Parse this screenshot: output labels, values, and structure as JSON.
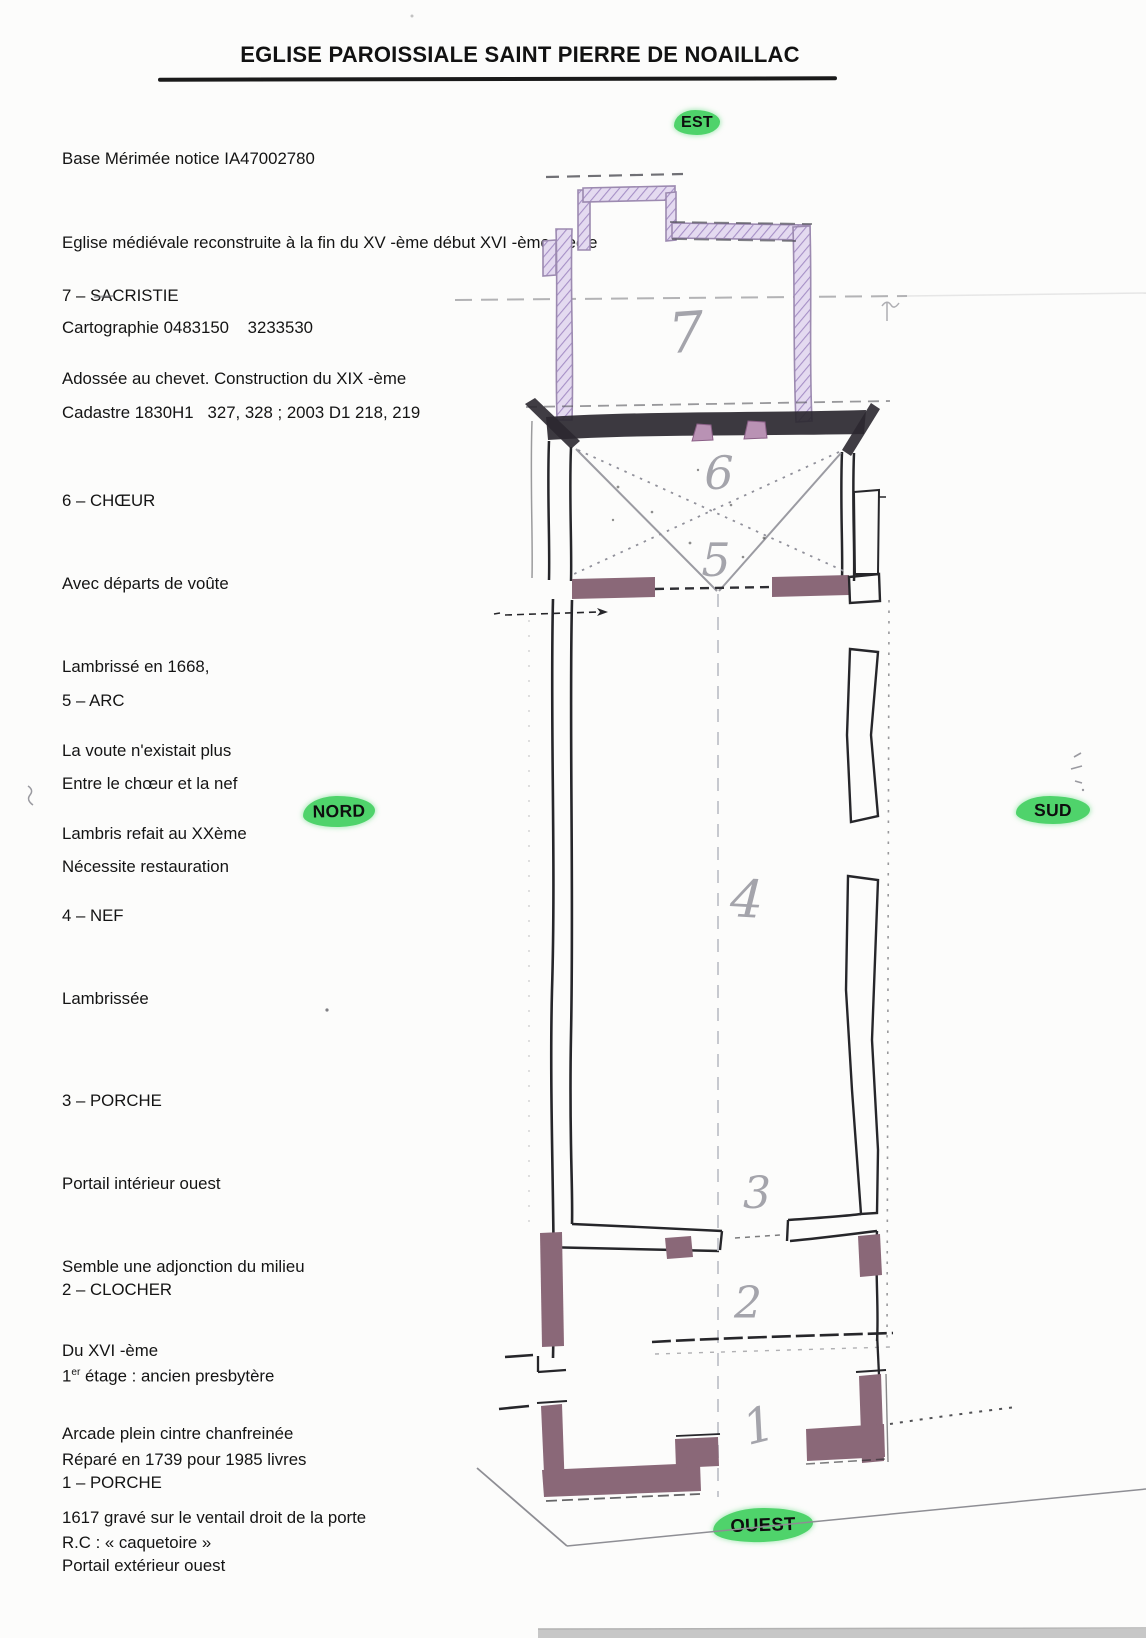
{
  "page_title": "EGLISE PAROISSIALE SAINT PIERRE DE NOAILLAC",
  "header": {
    "line1": "Base Mérimée notice IA47002780",
    "line2": "Eglise médiévale reconstruite à la fin du XV -ème début XVI -ème siècle",
    "line3": "Cartographie 0483150    3233530",
    "line4": "Cadastre 1830H1   327, 328 ; 2003 D1 218, 219"
  },
  "compass": {
    "est": "EST",
    "nord": "NORD",
    "sud": "SUD",
    "ouest": "OUEST"
  },
  "sections": {
    "s7": {
      "heading": "7 – SACRISTIE",
      "l1": "Adossée au chevet. Construction du XIX -ème"
    },
    "s6": {
      "heading": "6 – CHŒUR",
      "l1": "Avec départs de voûte",
      "l2": "Lambrissé en 1668,",
      "l3": "La voute n'existait plus",
      "l4": "Lambris refait au XXème"
    },
    "s5": {
      "heading": "5 – ARC",
      "l1": "Entre le chœur et la nef",
      "l2": "Nécessite restauration"
    },
    "s4": {
      "heading": "4 – NEF",
      "l1": "Lambrissée"
    },
    "s3": {
      "heading": "3 – PORCHE",
      "l1": "Portail intérieur ouest",
      "l2": "Semble une adjonction du milieu",
      "l3": "Du XVI -ème",
      "l4": "Arcade plein cintre chanfreinée",
      "l5": "1617 gravé sur le ventail droit de la porte"
    },
    "s2": {
      "heading": "2 – CLOCHER",
      "l1_num": "1",
      "l1_sup": "er",
      "l1_rest": " étage : ancien presbytère",
      "l2": "Réparé en 1739 pour 1985 livres",
      "l3": "R.C : « caquetoire »"
    },
    "s1": {
      "heading": "1 – PORCHE",
      "l1": "Portail extérieur ouest"
    }
  },
  "plan": {
    "room_numbers": {
      "r7": "7",
      "r6": "6",
      "r5": "5",
      "r4": "4",
      "r3": "3",
      "r2": "2",
      "r1": "1"
    }
  },
  "colors": {
    "highlight_green": "#4fd36b",
    "wall_mauve": "#8a6878",
    "pencil_purple": "#9c8ab0",
    "ink": "#26262a"
  }
}
